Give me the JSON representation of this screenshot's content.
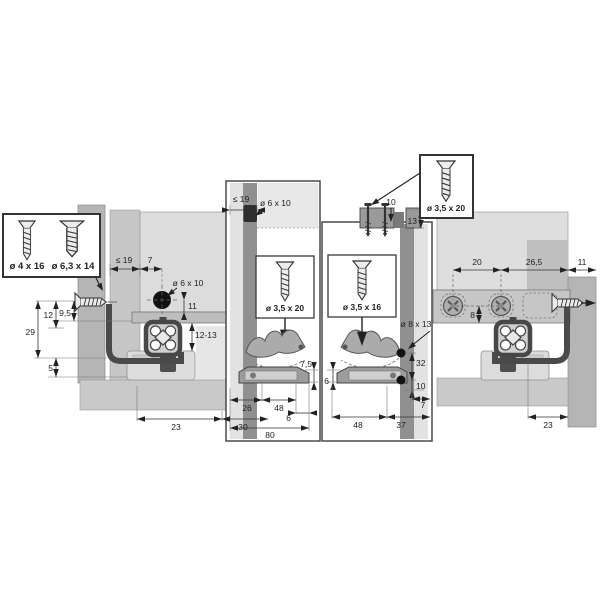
{
  "boxes": {
    "left": {
      "screw_small": "ø 4 x 16",
      "screw_large": "ø 6,3 x 14"
    },
    "right": {
      "screw": "ø 3,5 x 20"
    }
  },
  "side_left": {
    "panel_max": "≤ 19",
    "offset": "7",
    "hole": "ø 6 x 10",
    "hole_depth": "11",
    "range": "12-13",
    "d12": "12",
    "d9_5": "9,5",
    "d29": "29",
    "d5": "5",
    "d23": "23",
    "d30": "30"
  },
  "front_left": {
    "panel_max": "≤ 19",
    "hole": "ø 6 x 10",
    "screw": "ø 3,5 x 20",
    "d7_5": "7,5",
    "d26": "26",
    "d48": "48",
    "d6": "6",
    "d80": "80"
  },
  "front_right": {
    "d10_top": "10",
    "d13": "13",
    "screw": "ø 3,5 x 16",
    "hole": "ø 8 x 13",
    "d32": "32",
    "d10": "10",
    "d6": "6",
    "d48": "48",
    "d37": "37",
    "d7": "7"
  },
  "side_right": {
    "d20": "20",
    "d26_5": "26,5",
    "d11": "11",
    "d8": "8",
    "d23": "23"
  },
  "icons": {
    "screw": "flat-head-screw-icon",
    "drill_hole": "drill-hole-dot-icon",
    "arrow": "direction-arrow-icon",
    "profile": "runner-profile-section-icon"
  },
  "colors": {
    "line": "#3a3a3a",
    "panel": "#b5b5b5",
    "panel_light": "#dcdcdc",
    "strip_dark": "#909090",
    "hole_dark": "#2f2f2f",
    "band": "#c9c9c9"
  }
}
